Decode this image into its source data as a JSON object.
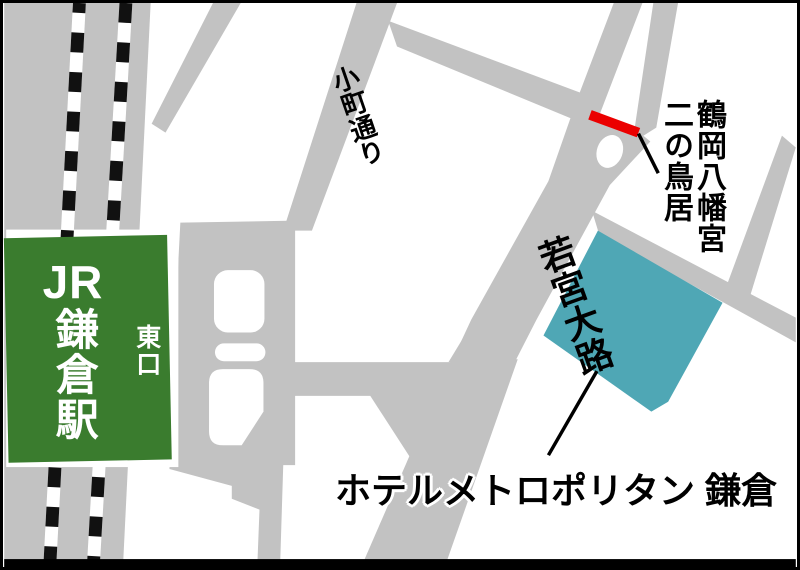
{
  "map": {
    "station": {
      "prefix": "JR",
      "name": "鎌倉駅",
      "east_exit": "東口"
    },
    "streets": {
      "komachi_dori": "小町通り",
      "wakamiya_oji": "若宮大路"
    },
    "torii": {
      "shrine": "鶴岡八幡宮",
      "gate": "二の鳥居"
    },
    "hotel": {
      "name": "ホテルメトロポリタン 鎌倉"
    },
    "colors": {
      "road_gray": "#C2C2C2",
      "station_green": "#3A7C2E",
      "hotel_teal": "#4FA7B5",
      "marker_red": "#EB0000",
      "railway_black": "#111111",
      "frame_black": "#000000"
    }
  }
}
